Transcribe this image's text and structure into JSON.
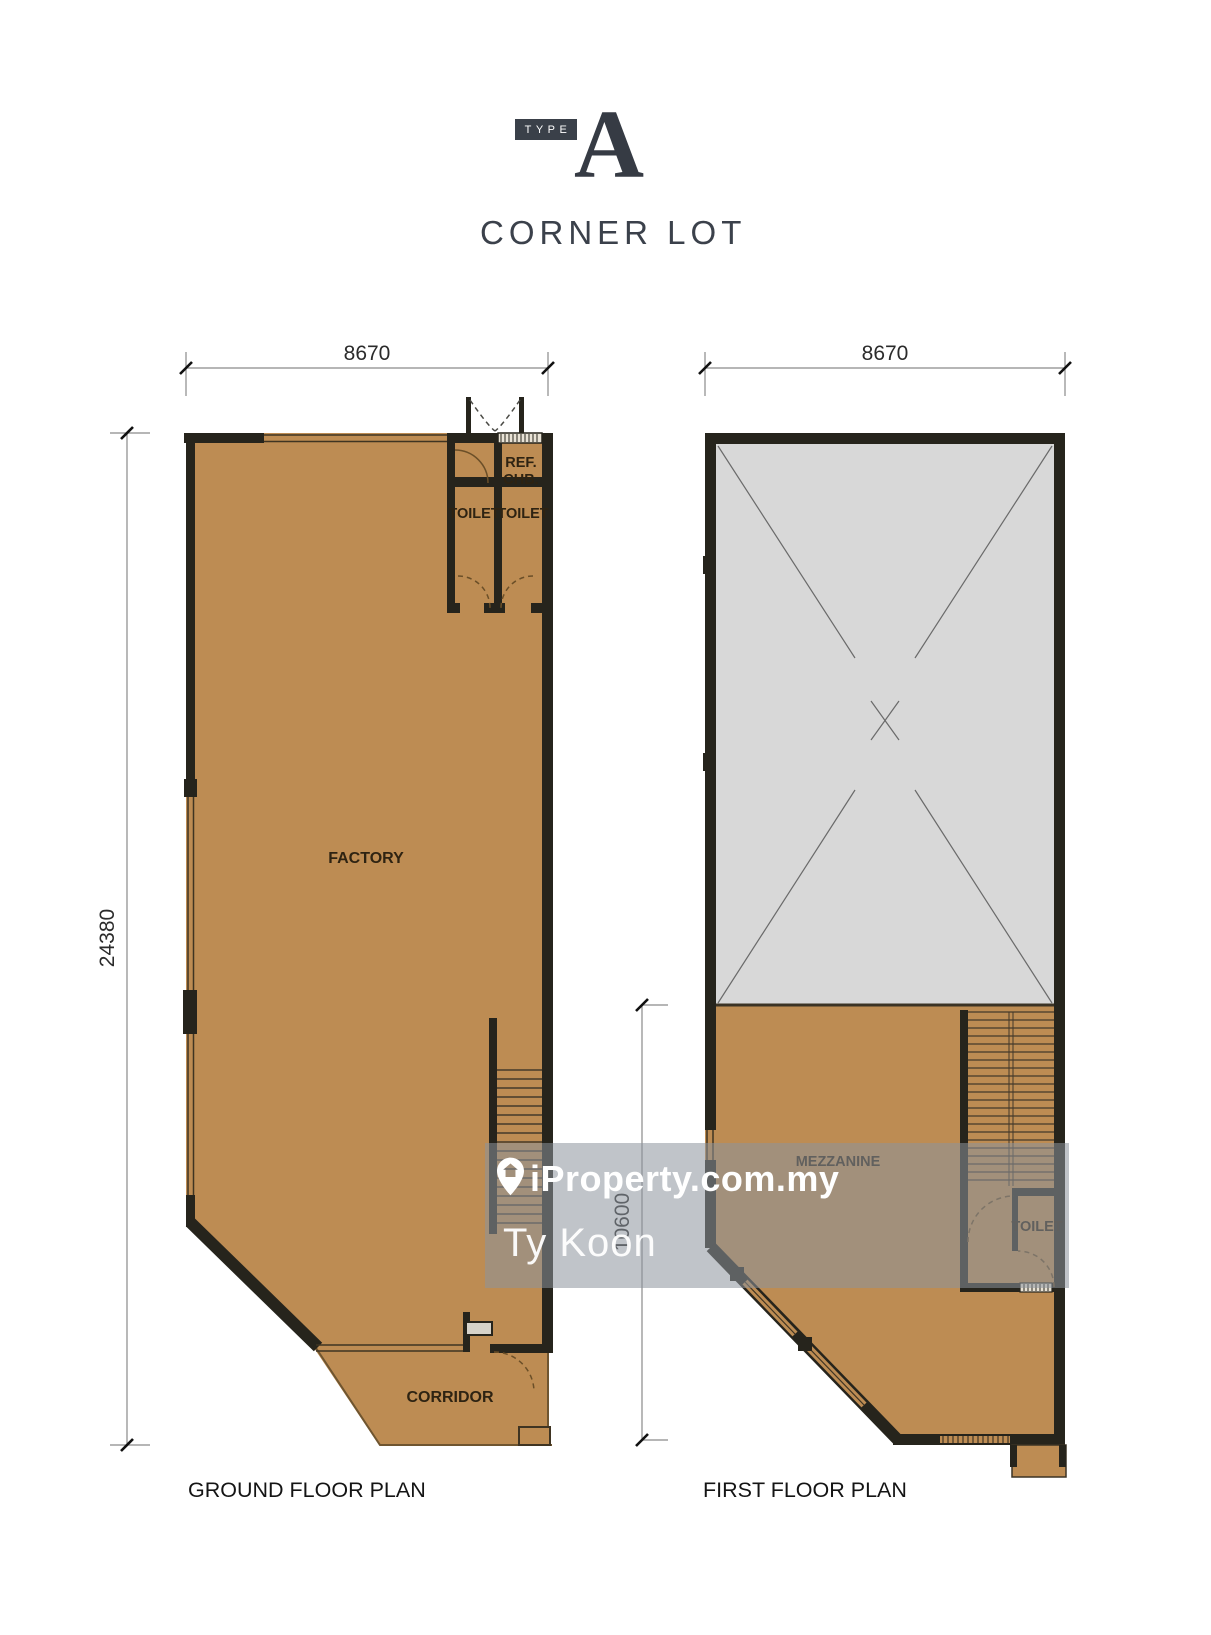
{
  "title": {
    "badge": "TYPE",
    "letter": "A",
    "subtitle": "CORNER LOT"
  },
  "watermark": {
    "brand": "iProperty.com.my",
    "agent": "Ty Koon",
    "pin_icon": "map-pin-house-icon"
  },
  "ground_floor": {
    "label": "GROUND FLOOR PLAN",
    "dims": {
      "width": "8670",
      "height": "24380"
    },
    "rooms": {
      "factory": "FACTORY",
      "ref_chb_line1": "REF.",
      "ref_chb_line2": "CHB.",
      "toilet_left": "TOILET",
      "toilet_right": "TOILET",
      "corridor": "CORRIDOR"
    }
  },
  "first_floor": {
    "label": "FIRST FLOOR PLAN",
    "dims": {
      "width": "8670",
      "height": "10600"
    },
    "rooms": {
      "mezzanine": "MEZZANINE",
      "toilet": "TOILET"
    }
  },
  "colors": {
    "floor": "#bd8c53",
    "wall": "#26241c",
    "void_fill": "#d8d8d8",
    "accent": "#3a4049",
    "watermark_text": "#ffffff"
  }
}
